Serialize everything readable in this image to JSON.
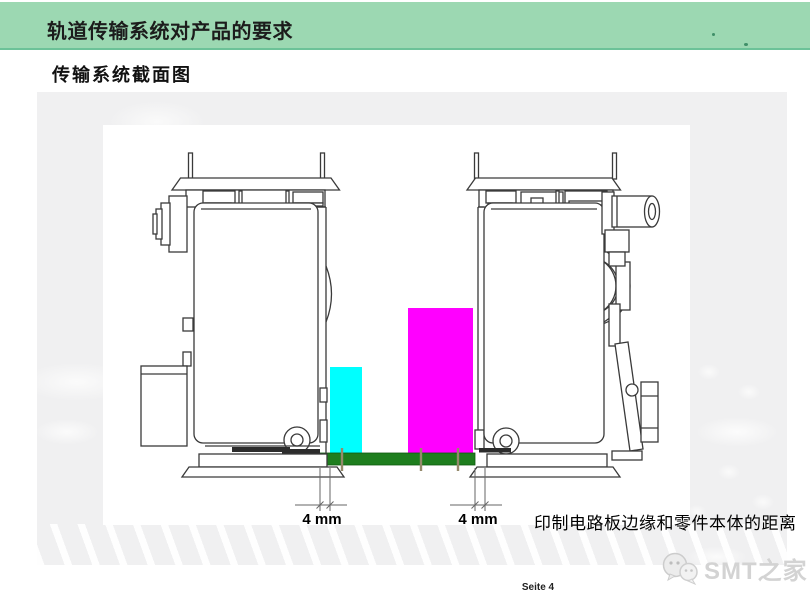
{
  "header": {
    "title": "轨道传输系统对产品的要求",
    "bar_color": "#9cd8b2",
    "bar_border_color": "#6cc298"
  },
  "subtitle": "传输系统截面图",
  "diagram": {
    "dim_left_label": "4 mm",
    "dim_right_label": "4 mm",
    "caption": "印制电路板边缘和零件本体的距离",
    "colors": {
      "component_small": "#00ffff",
      "component_large": "#ff00ff",
      "pcb": "#1e7e1e",
      "pcb_edge": "#0d5a0d"
    }
  },
  "footer": {
    "page_label": "Seite 4"
  },
  "watermark": {
    "text": "SMT之家",
    "icon": "wechat-icon"
  }
}
